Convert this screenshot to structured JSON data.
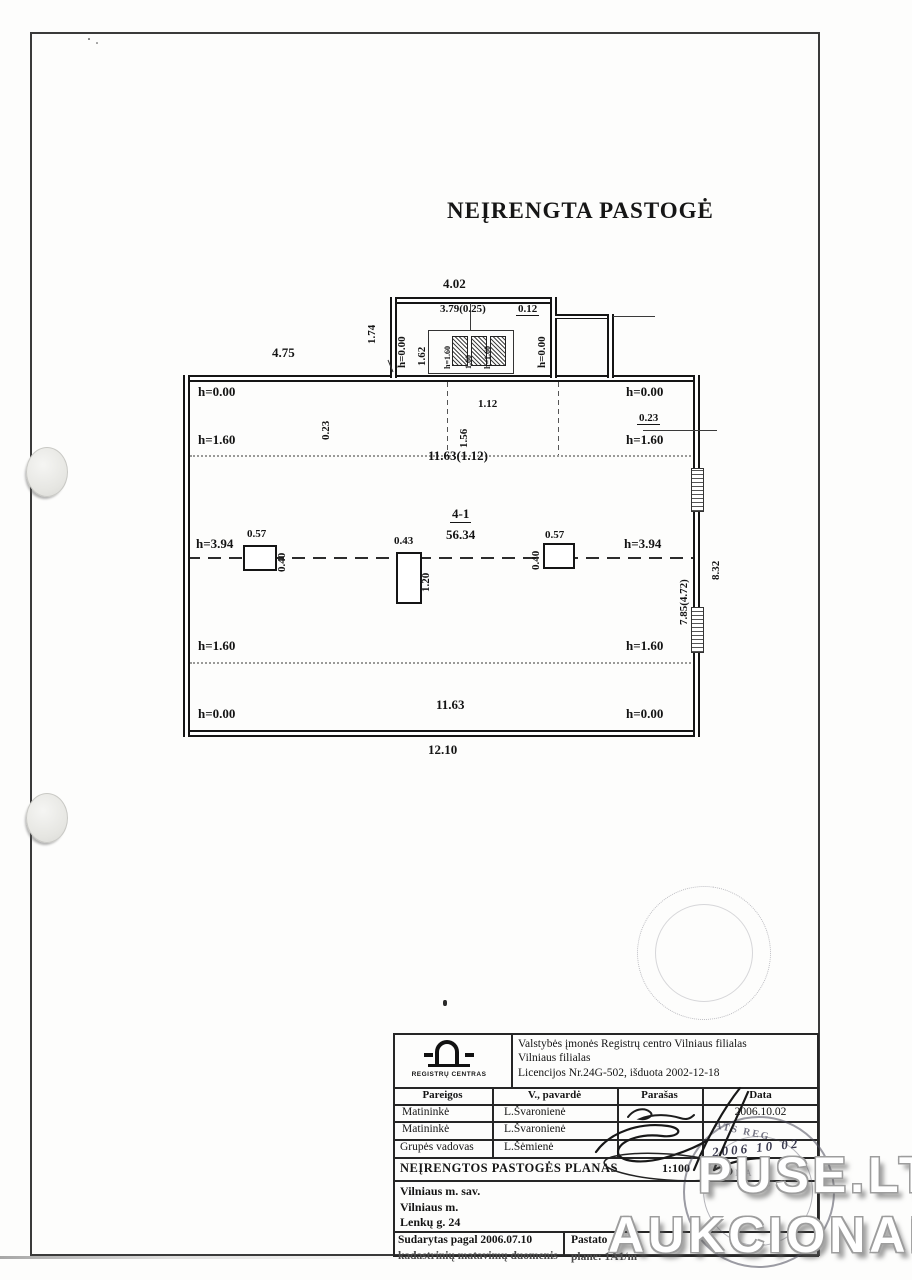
{
  "page": {
    "heading": "NEĮRENGTA PASTOGĖ",
    "watermark_line1": "PUSE.LT",
    "watermark_line2": "AUKCIONAI"
  },
  "plan": {
    "room_code": "4-1",
    "room_area": "56.34",
    "h000": "h=0.00",
    "h160": "h=1.60",
    "h394": "h=3.94",
    "d402": "4.02",
    "d379": "3.79(0.25)",
    "d012": "0.12",
    "d174": "1.74",
    "d162": "1.62",
    "dormer_stack": [
      "h=1.60",
      "1.60",
      "h=1.60"
    ],
    "d475": "4.75",
    "d023": "0.23",
    "d112": "1.12",
    "d156": "1.56",
    "d1163a": "11.63(1.12)",
    "d1163b": "11.63",
    "d1210": "12.10",
    "d057": "0.57",
    "d040": "0.40",
    "d043": "0.43",
    "d120": "1.20",
    "d785": "7.85(4.72)",
    "d832": "8.32"
  },
  "titleblock": {
    "logo_caption": "REGISTRŲ CENTRAS",
    "org_line1": "Valstybės įmonės Registrų centro Vilniaus filialas",
    "org_line2": "Vilniaus filialas",
    "org_line3": "Licencijos Nr.24G-502, išduota 2002-12-18",
    "col_headers": [
      "Pareigos",
      "V., pavardė",
      "Parašas",
      "Data"
    ],
    "rows": [
      {
        "pareigos": "Matininkė",
        "pavarde": "L.Švaronienė",
        "data": "2006.10.02"
      },
      {
        "pareigos": "Matininkė",
        "pavarde": "L.Švaronienė",
        "data": ""
      },
      {
        "pareigos": "Grupės vadovas",
        "pavarde": "L.Šėmienė",
        "data": ""
      }
    ],
    "plan_title": "NEĮRENGTOS PASTOGĖS PLANAS",
    "scale": "1:100",
    "address_line1": "Vilniaus m. sav.",
    "address_line2": "Vilniaus m.",
    "address_line3": "Lenkų g. 24",
    "footer_left_line1": "Sudarytas pagal 2006.07.10",
    "footer_left_line2": "kadastrinių matavimų duomenis",
    "footer_right_line1": "Pastato",
    "footer_right_line2": "plane: 1A1/m",
    "stamp_fragment": "ATS REG",
    "stamp_inner1": "MA",
    "stamp_inner2": "SENP",
    "stamp_date_hand": "2006 10 02"
  }
}
